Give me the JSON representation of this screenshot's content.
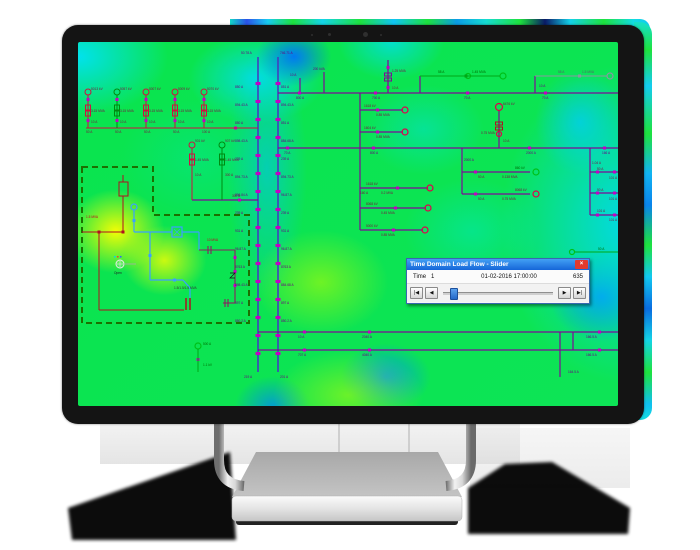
{
  "dialog": {
    "title": "Time Domain Load Flow - Slider",
    "close_glyph": "×",
    "time_label": "Time",
    "time_value": "1",
    "timestamp": "01-02-2016 17:00:00",
    "total_steps": "635",
    "btn_first": "|◀",
    "btn_prev": "◀",
    "btn_next": "▶",
    "btn_last": "▶|",
    "slider_position": "6%"
  },
  "diagram": {
    "colors": {
      "heat_green": "#0ee24a",
      "heat_cyan": "#12ccf0",
      "heat_blue": "#0a84ec",
      "heat_yellow": "#f4f400",
      "bus_purple": "#7d0a96",
      "tick_magenta": "#c400c4",
      "feeder_red": "#b01020",
      "feeder_green": "#00a816",
      "device_blue": "#3aa0ff",
      "dashed_zone_green": "#1c7000"
    },
    "labels": [
      {
        "t": "5013 kV",
        "x": 13,
        "y": 48
      },
      {
        "t": "5057 kV",
        "x": 42,
        "y": 48
      },
      {
        "t": "5007 kV",
        "x": 71,
        "y": 48
      },
      {
        "t": "5009 kV",
        "x": 100,
        "y": 48
      },
      {
        "t": "5070 kV",
        "x": 129,
        "y": 48
      },
      {
        "t": "3.15 MVA",
        "x": 13,
        "y": 70
      },
      {
        "t": "3.15 MVA",
        "x": 42,
        "y": 70
      },
      {
        "t": "3.15 MVA",
        "x": 71,
        "y": 70
      },
      {
        "t": "3.15 MVA",
        "x": 100,
        "y": 70
      },
      {
        "t": "3.15 MVA",
        "x": 129,
        "y": 70
      },
      {
        "t": "10 A",
        "x": 13,
        "y": 81
      },
      {
        "t": "10 A",
        "x": 42,
        "y": 81
      },
      {
        "t": "10 A",
        "x": 71,
        "y": 81
      },
      {
        "t": "10 A",
        "x": 100,
        "y": 81
      },
      {
        "t": "10 A",
        "x": 129,
        "y": 81
      },
      {
        "t": "50 A",
        "x": 8,
        "y": 91
      },
      {
        "t": "50 A",
        "x": 37,
        "y": 91
      },
      {
        "t": "50 A",
        "x": 66,
        "y": 91
      },
      {
        "t": "50 A",
        "x": 95,
        "y": 91
      },
      {
        "t": "100 A",
        "x": 124,
        "y": 91
      },
      {
        "t": "901 kV",
        "x": 117,
        "y": 100
      },
      {
        "t": "907 kV",
        "x": 147,
        "y": 100
      },
      {
        "t": "1.45 MVA",
        "x": 117,
        "y": 119
      },
      {
        "t": "1.45 MVA",
        "x": 147,
        "y": 119
      },
      {
        "t": "10 A",
        "x": 117,
        "y": 134
      },
      {
        "t": "300 A",
        "x": 147,
        "y": 134
      },
      {
        "t": "300 A",
        "x": 154,
        "y": 155
      },
      {
        "t": "50.78 A",
        "x": 163,
        "y": 12,
        "c": "#6a0080"
      },
      {
        "t": "746.71 A",
        "x": 202,
        "y": 12,
        "c": "#6a0080"
      },
      {
        "t": "219 A",
        "x": 166,
        "y": 336,
        "c": "#6a0080"
      },
      {
        "t": "201 A",
        "x": 202,
        "y": 336,
        "c": "#6a0080"
      },
      {
        "t": "850 A",
        "x": 157,
        "y": 46,
        "c": "#6a0080"
      },
      {
        "t": "851 A",
        "x": 203,
        "y": 46,
        "c": "#6a0080"
      },
      {
        "t": "894.43 A",
        "x": 157,
        "y": 64,
        "c": "#6a0080"
      },
      {
        "t": "894.43 A",
        "x": 203,
        "y": 64,
        "c": "#6a0080"
      },
      {
        "t": "850 A",
        "x": 157,
        "y": 82,
        "c": "#6a0080"
      },
      {
        "t": "851 A",
        "x": 203,
        "y": 82,
        "c": "#6a0080"
      },
      {
        "t": "898.43 A",
        "x": 157,
        "y": 100,
        "c": "#6a0080"
      },
      {
        "t": "884.68 A",
        "x": 203,
        "y": 100,
        "c": "#6a0080"
      },
      {
        "t": "239 A",
        "x": 157,
        "y": 118,
        "c": "#6a0080"
      },
      {
        "t": "239 A",
        "x": 203,
        "y": 118,
        "c": "#6a0080"
      },
      {
        "t": "894.73 A",
        "x": 157,
        "y": 136,
        "c": "#6a0080"
      },
      {
        "t": "894.73 A",
        "x": 203,
        "y": 136,
        "c": "#6a0080"
      },
      {
        "t": "896.84 A",
        "x": 157,
        "y": 154,
        "c": "#6a0080"
      },
      {
        "t": "96.87 A",
        "x": 203,
        "y": 154,
        "c": "#6a0080"
      },
      {
        "t": "239 A",
        "x": 157,
        "y": 172,
        "c": "#6a0080"
      },
      {
        "t": "239 A",
        "x": 203,
        "y": 172,
        "c": "#6a0080"
      },
      {
        "t": "931 A",
        "x": 157,
        "y": 190,
        "c": "#6a0080"
      },
      {
        "t": "931 A",
        "x": 203,
        "y": 190,
        "c": "#6a0080"
      },
      {
        "t": "96.87 A",
        "x": 157,
        "y": 208,
        "c": "#6a0080"
      },
      {
        "t": "96.87 A",
        "x": 203,
        "y": 208,
        "c": "#6a0080"
      },
      {
        "t": "8763 A",
        "x": 157,
        "y": 226,
        "c": "#6a0080"
      },
      {
        "t": "8763 A",
        "x": 203,
        "y": 226,
        "c": "#6a0080"
      },
      {
        "t": "898.43 A",
        "x": 157,
        "y": 244,
        "c": "#6a0080"
      },
      {
        "t": "884.68 A",
        "x": 203,
        "y": 244,
        "c": "#6a0080"
      },
      {
        "t": "897 A",
        "x": 157,
        "y": 262,
        "c": "#6a0080"
      },
      {
        "t": "897 A",
        "x": 203,
        "y": 262,
        "c": "#6a0080"
      },
      {
        "t": "850.2 A",
        "x": 157,
        "y": 280,
        "c": "#6a0080"
      },
      {
        "t": "850.2 A",
        "x": 203,
        "y": 280,
        "c": "#6a0080"
      },
      {
        "t": "800 A",
        "x": 218,
        "y": 57,
        "c": "#6a0080"
      },
      {
        "t": "700 A",
        "x": 294,
        "y": 57,
        "c": "#6a0080"
      },
      {
        "t": "70 A",
        "x": 386,
        "y": 57,
        "c": "#6a0080"
      },
      {
        "t": "70 A",
        "x": 464,
        "y": 57,
        "c": "#6a0080"
      },
      {
        "t": "200 kVA",
        "x": 235,
        "y": 28,
        "c": "#6a0080"
      },
      {
        "t": "10 A",
        "x": 212,
        "y": 34,
        "c": "#6a0080"
      },
      {
        "t": "1.25 MVA",
        "x": 314,
        "y": 30
      },
      {
        "t": "10 A",
        "x": 314,
        "y": 47
      },
      {
        "t": "58 A",
        "x": 360,
        "y": 31,
        "c": "#006a00"
      },
      {
        "t": "1.45 MVA",
        "x": 394,
        "y": 31,
        "c": "#006a00"
      },
      {
        "t": "58 A",
        "x": 480,
        "y": 31,
        "c": "#55606a"
      },
      {
        "t": "1.5 MVA",
        "x": 504,
        "y": 31,
        "c": "#55606a"
      },
      {
        "t": "10 A",
        "x": 461,
        "y": 45,
        "c": "#6a0080"
      },
      {
        "t": "1618 kV",
        "x": 286,
        "y": 65
      },
      {
        "t": "0.85 MVA",
        "x": 298,
        "y": 74
      },
      {
        "t": "1604 kV",
        "x": 286,
        "y": 87
      },
      {
        "t": "0.85 MVA",
        "x": 298,
        "y": 96
      },
      {
        "t": "6476 kV",
        "x": 425,
        "y": 63
      },
      {
        "t": "0.75 MVA",
        "x": 403,
        "y": 92
      },
      {
        "t": "10 A",
        "x": 425,
        "y": 100
      },
      {
        "t": "70 A",
        "x": 206,
        "y": 112,
        "c": "#6a0080"
      },
      {
        "t": "800 A",
        "x": 292,
        "y": 112,
        "c": "#6a0080"
      },
      {
        "t": "2000 A",
        "x": 448,
        "y": 112,
        "c": "#6a0080"
      },
      {
        "t": "166 A",
        "x": 524,
        "y": 112,
        "c": "#6a0080"
      },
      {
        "t": "2000 A",
        "x": 386,
        "y": 119,
        "c": "#6a0080"
      },
      {
        "t": "50 A",
        "x": 400,
        "y": 136
      },
      {
        "t": "0.138 MVA",
        "x": 424,
        "y": 136
      },
      {
        "t": "860 kV",
        "x": 437,
        "y": 127,
        "c": "#006a00"
      },
      {
        "t": "50 A",
        "x": 400,
        "y": 158
      },
      {
        "t": "0.75 MVA",
        "x": 424,
        "y": 158
      },
      {
        "t": "8068 kV",
        "x": 437,
        "y": 149
      },
      {
        "t": "1.04 A",
        "x": 514,
        "y": 122
      },
      {
        "t": "50 A",
        "x": 519,
        "y": 128
      },
      {
        "t": "50 A",
        "x": 519,
        "y": 149
      },
      {
        "t": "101 A",
        "x": 519,
        "y": 170
      },
      {
        "t": "101 A",
        "x": 531,
        "y": 137
      },
      {
        "t": "101 A",
        "x": 531,
        "y": 158
      },
      {
        "t": "101 A",
        "x": 531,
        "y": 179
      },
      {
        "t": "1618 kV",
        "x": 288,
        "y": 143
      },
      {
        "t": "0.2 MVA",
        "x": 303,
        "y": 152
      },
      {
        "t": "160 A",
        "x": 282,
        "y": 152
      },
      {
        "t": "8068 kV",
        "x": 288,
        "y": 163
      },
      {
        "t": "0.45 MVA",
        "x": 303,
        "y": 172
      },
      {
        "t": "5000 kV",
        "x": 288,
        "y": 185
      },
      {
        "t": "0.85 MVA",
        "x": 303,
        "y": 194
      },
      {
        "t": "10 A",
        "x": 220,
        "y": 296,
        "c": "#6a0080"
      },
      {
        "t": "2040 A",
        "x": 284,
        "y": 296,
        "c": "#6a0080"
      },
      {
        "t": "166.5 A",
        "x": 508,
        "y": 296,
        "c": "#6a0080"
      },
      {
        "t": "707 A",
        "x": 220,
        "y": 314,
        "c": "#6a0080"
      },
      {
        "t": "4040 A",
        "x": 284,
        "y": 314,
        "c": "#6a0080"
      },
      {
        "t": "166.5 A",
        "x": 508,
        "y": 314,
        "c": "#6a0080"
      },
      {
        "t": "164.5 A",
        "x": 490,
        "y": 331,
        "c": "#6a0080"
      },
      {
        "t": "500 A",
        "x": 125,
        "y": 303,
        "c": "#006a00"
      },
      {
        "t": "1.1 kV",
        "x": 125,
        "y": 324,
        "c": "#006a00"
      },
      {
        "t": "50 A",
        "x": 520,
        "y": 208,
        "c": "#006a00"
      },
      {
        "t": "1.5 MVA",
        "x": 8,
        "y": 176,
        "c": "#c00020"
      },
      {
        "t": "10 MVA",
        "x": 129,
        "y": 199,
        "c": "#c00020"
      },
      {
        "t": "1.5/1.5/1.5 MVA",
        "x": 96,
        "y": 247,
        "c": "#333333"
      },
      {
        "t": "Open",
        "x": 36,
        "y": 232,
        "c": "#222222"
      }
    ]
  }
}
